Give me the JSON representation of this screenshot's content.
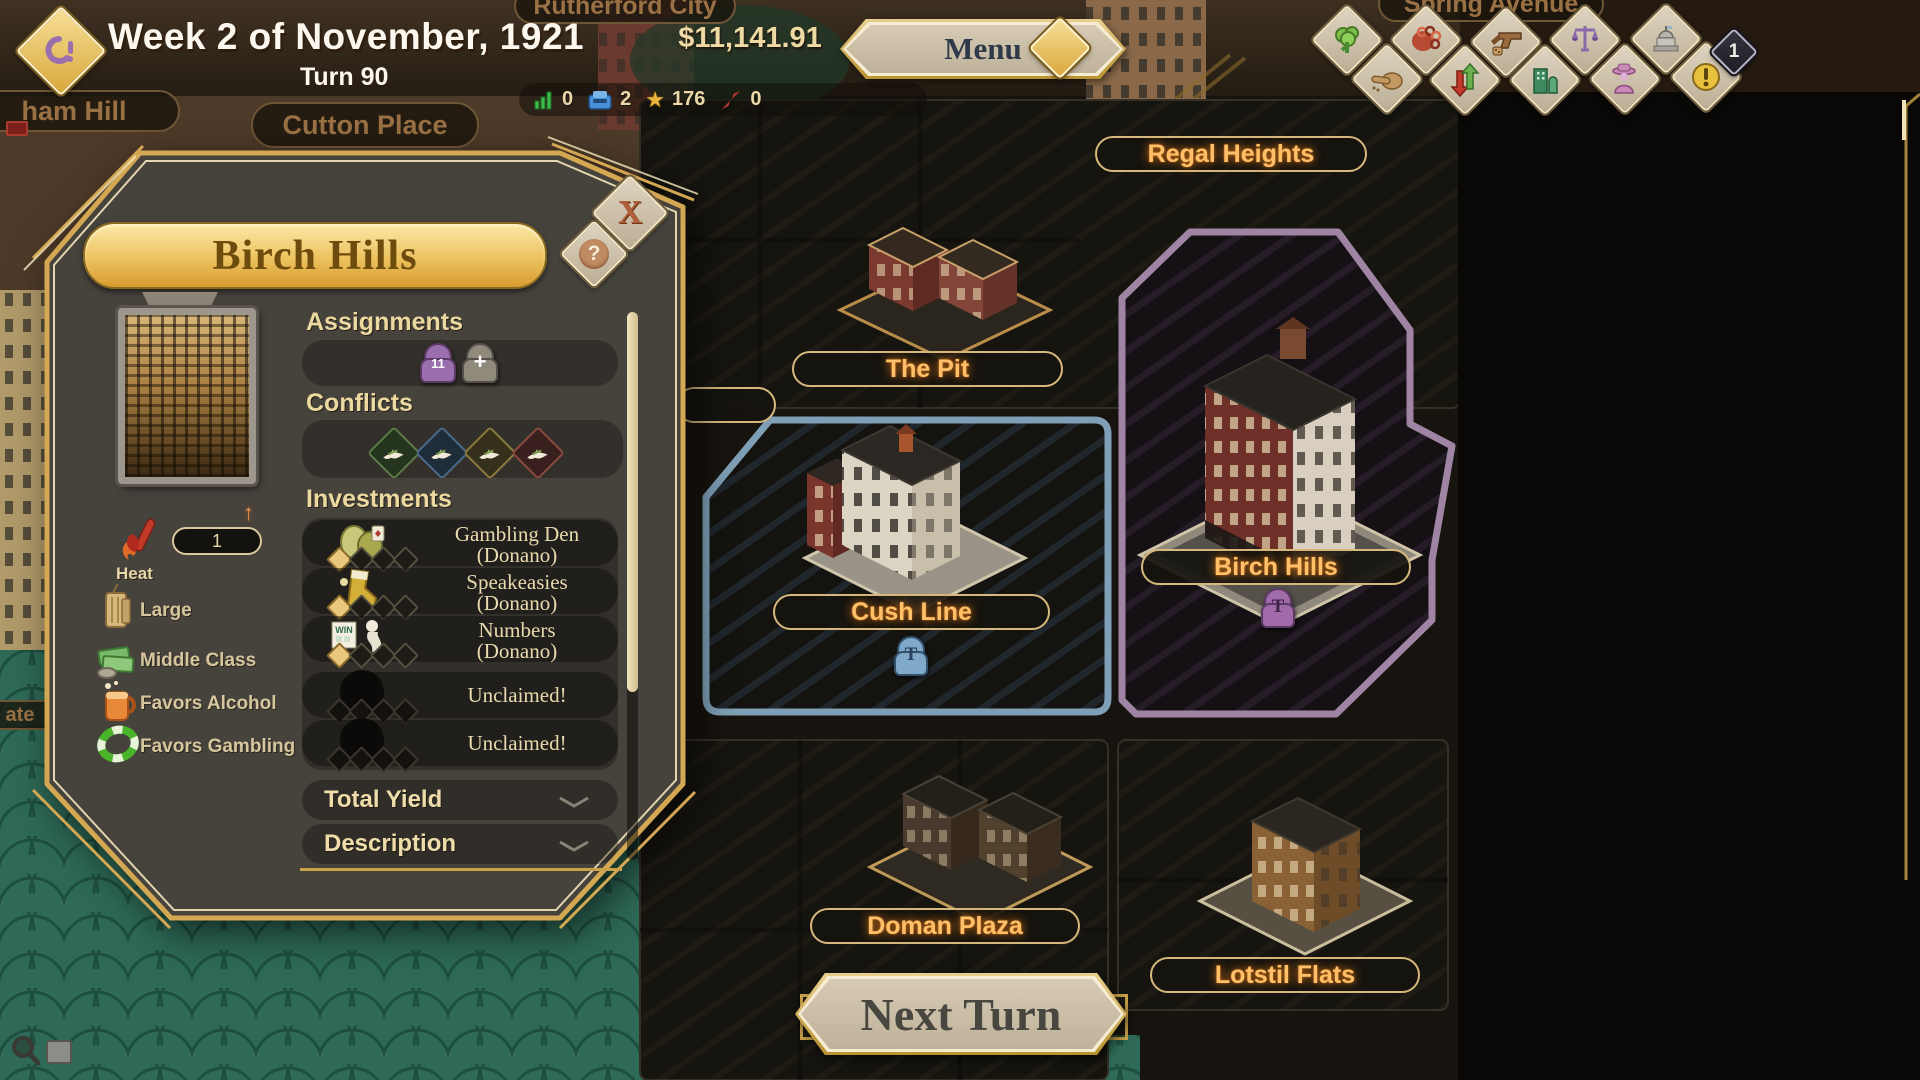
{
  "topbar": {
    "date": "Week 2 of November, 1921",
    "turn": "Turn 90",
    "money": "$11,141.91",
    "menu_label": "Menu",
    "stats": [
      {
        "icon": "bar-chart",
        "value": "0"
      },
      {
        "icon": "inbox",
        "value": "2"
      },
      {
        "icon": "star",
        "value": "176"
      },
      {
        "icon": "dagger",
        "value": "0"
      }
    ],
    "notification_badge": "1"
  },
  "panel": {
    "title": "Birch Hills",
    "close_glyph": "X",
    "help_glyph": "?",
    "sections": {
      "assignments": "Assignments",
      "conflicts": "Conflicts",
      "investments": "Investments",
      "total_yield": "Total Yield",
      "description": "Description"
    },
    "assignment_count": "11",
    "add_glyph": "+",
    "stats": {
      "heat_label": "Heat",
      "heat_value": "1",
      "size": "Large",
      "class": "Middle Class",
      "favor_alcohol": "Favors Alcohol",
      "favor_gambling": "Favors Gambling"
    },
    "investments": [
      {
        "name": "Gambling Den",
        "owner": "(Donano)"
      },
      {
        "name": "Speakeasies",
        "owner": "(Donano)"
      },
      {
        "name": "Numbers",
        "owner": "(Donano)"
      },
      {
        "name": "Unclaimed!",
        "owner": ""
      },
      {
        "name": "Unclaimed!",
        "owner": ""
      }
    ]
  },
  "map": {
    "locations": {
      "regal": "Regal Heights",
      "pit": "The Pit",
      "cush": "Cush Line",
      "birch": "Birch Hills",
      "doman": "Doman Plaza",
      "lotstil": "Lotstil Flats"
    },
    "dim_labels": {
      "rutherford": "Rutherford City",
      "spring": "Spring Avenue",
      "cutton": "Cutton Place",
      "ham": "ham Hill",
      "ate": "ate"
    },
    "tokens": {
      "cush": "T",
      "birch": "T"
    },
    "region_colors": {
      "cush": "#7e9fb5",
      "birch": "#9f84a4"
    }
  },
  "actions": {
    "next_turn": "Next Turn"
  },
  "colors": {
    "gold": "#d9ad5f",
    "label_glow": "#ffc069",
    "money": "#eed9a4",
    "teal": "#2e6a57"
  }
}
